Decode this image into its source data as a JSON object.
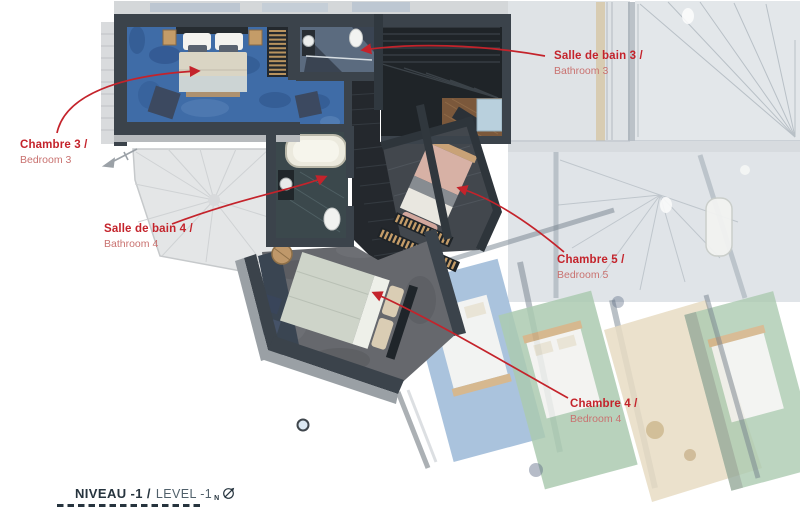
{
  "callouts": [
    {
      "fr": "Chambre 3 /",
      "en": "Bedroom 3"
    },
    {
      "fr": "Salle de bain 3 /",
      "en": "Bathroom 3"
    },
    {
      "fr": "Salle de bain 4 /",
      "en": "Bathroom 4"
    },
    {
      "fr": "Chambre 5 /",
      "en": "Bedroom 5"
    },
    {
      "fr": "Chambre 4 /",
      "en": "Bedroom 4"
    }
  ],
  "footer": {
    "level_fr": "NIVEAU -1 /",
    "level_en": "LEVEL -1",
    "north_letter": "N"
  },
  "icons": {
    "north": "north-arrow-icon"
  },
  "colors": {
    "accent_red": "#c4232b",
    "label_red_soft": "#c97270",
    "footer_dark": "#26343e",
    "footer_light": "#50606a",
    "wall_dark": "#3b434b",
    "carpet_blue": "#3f6ca7",
    "carpet_gray": "#66686d",
    "stair_dark": "#1f2428",
    "bed_linen": "#dad5c4",
    "bed_pink": "#d7b1a5",
    "wood": "#c49c68"
  }
}
